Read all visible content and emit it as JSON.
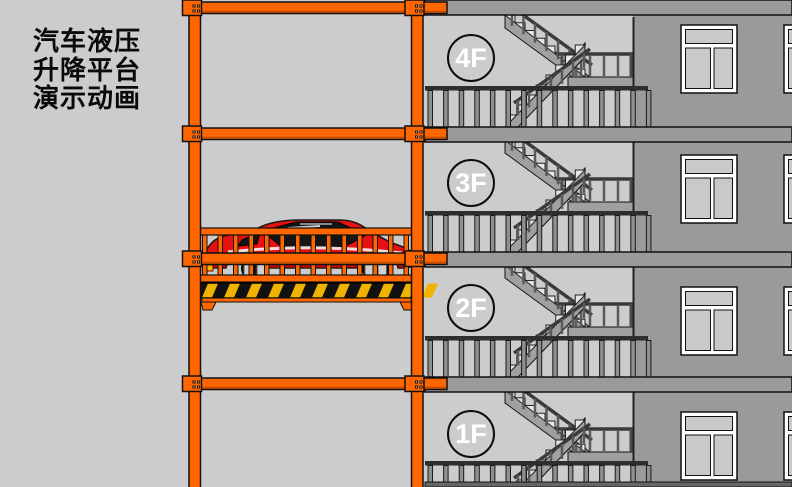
{
  "title": {
    "lines": [
      "汽车液压",
      "升降平台",
      "演示动画"
    ]
  },
  "floors": [
    {
      "label": "4F"
    },
    {
      "label": "3F"
    },
    {
      "label": "2F"
    },
    {
      "label": "1F"
    }
  ],
  "colors": {
    "background": "#cccccc",
    "wall": "#9a9a9a",
    "stairwell": "#cccccc",
    "outline": "#111111",
    "stair_gray": "#a0a0a0",
    "step_light": "#e6e6e6",
    "rail_dark": "#3a3a3a",
    "baluster_gray": "#8f8f8f",
    "frame_orange": "#ff6600",
    "frame_shadow": "#bf4c00",
    "badge_blue": "#1343e8",
    "badge_text": "#ffffff",
    "car_red": "#e81010",
    "car_red_dark": "#9c0000",
    "car_glass": "#151515",
    "car_highlight": "#ffffff",
    "hazard_yellow": "#f0b400",
    "hazard_black": "#111111",
    "window_frame": "#ffffff",
    "window_pane": "#c9c9c9",
    "ground": "#666666"
  }
}
